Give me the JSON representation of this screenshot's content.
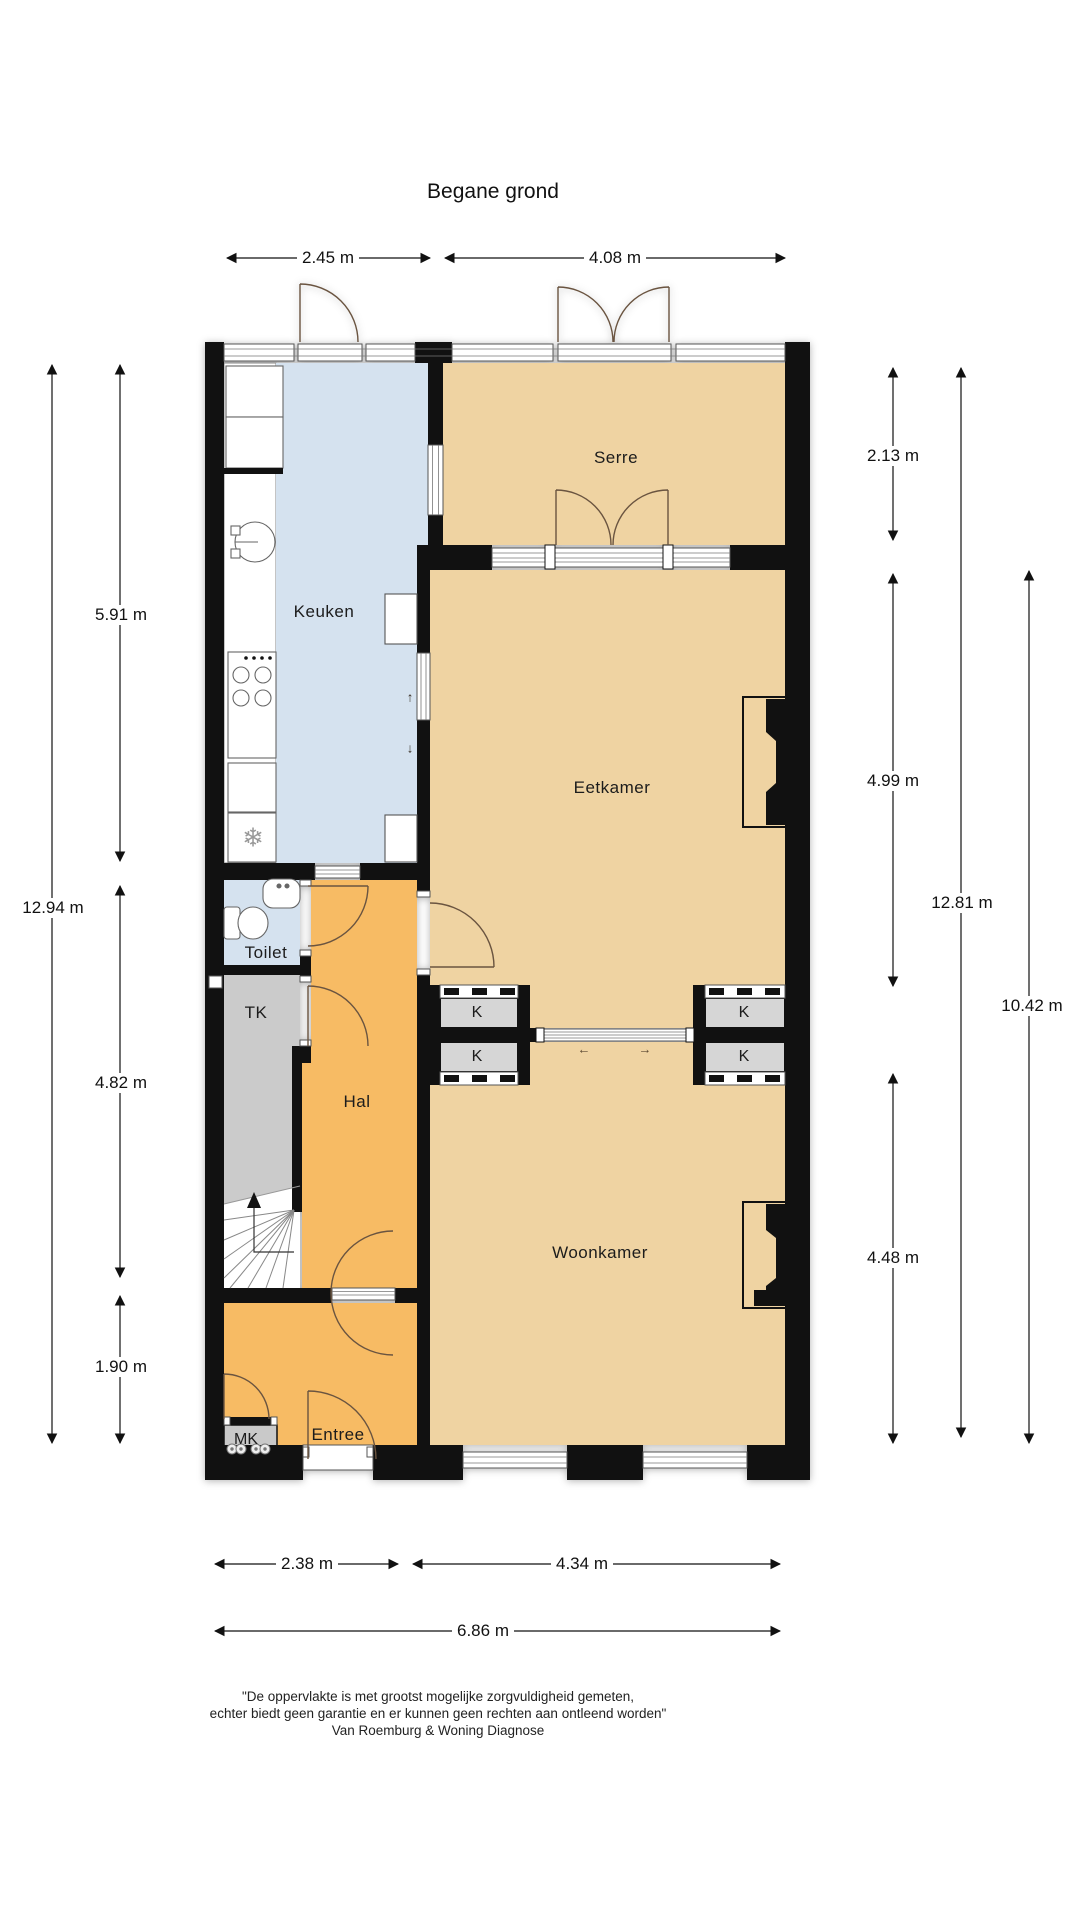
{
  "title": "Begane grond",
  "rooms": {
    "keuken": "Keuken",
    "serre": "Serre",
    "eetkamer": "Eetkamer",
    "woonkamer": "Woonkamer",
    "toilet": "Toilet",
    "hal": "Hal",
    "entree": "Entree",
    "tk": "TK",
    "mk": "MK",
    "kast": "K"
  },
  "dimensions": {
    "top": [
      "2.45 m",
      "4.08 m"
    ],
    "bottom": [
      "2.38 m",
      "4.34 m",
      "6.86 m"
    ],
    "left": [
      "12.94 m",
      "5.91 m",
      "4.82 m",
      "1.90 m"
    ],
    "right": [
      "2.13 m",
      "4.99 m",
      "4.48 m",
      "12.81 m",
      "10.42 m"
    ]
  },
  "icons": {
    "freezer": "❄",
    "arrow_up": "↑",
    "arrow_down": "↓",
    "slide_left": "←",
    "slide_right": "→"
  },
  "footer": [
    "\"De oppervlakte is met grootst mogelijke zorgvuldigheid gemeten,",
    "echter biedt geen garantie en er kunnen geen rechten aan ontleend worden\"",
    "Van Roemburg & Woning Diagnose"
  ],
  "colors": {
    "wall": "#111111",
    "room_tan": "#efd3a2",
    "room_blue": "#d5e2ef",
    "room_orange": "#f7bb64",
    "room_gray": "#cbcbcb",
    "closet_gray": "#d6d6d6"
  }
}
